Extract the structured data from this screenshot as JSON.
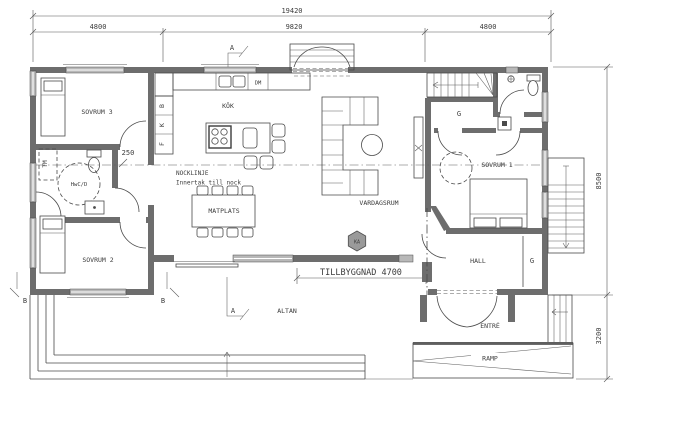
{
  "plan": {
    "dims": {
      "total": "19420",
      "seg_left": "4800",
      "seg_mid": "9820",
      "seg_right": "4800",
      "depth_main": "8500",
      "depth_lower": "3200",
      "corridor": "250",
      "extension": "TILLBYGGNAD 4700"
    },
    "rooms": {
      "sovrum3": "SOVRUM 3",
      "sovrum2": "SOVRUM 2",
      "sovrum1": "SOVRUM 1",
      "bathroom": "HwC/D",
      "kitchen": "KÖK",
      "dining": "MATPLATS",
      "living": "VARDAGSRUM",
      "hall": "HALL",
      "entry": "ENTRÉ",
      "terrace": "ALTAN",
      "ramp": "RAMP"
    },
    "fixtures": {
      "washing_machine": "TM",
      "dishwasher": "DM",
      "cabinet_top": "B",
      "cabinet_mid": "K",
      "cabinet_bottom": "F",
      "wardrobe_upper": "G",
      "wardrobe_hall": "G",
      "badge": "KA"
    },
    "notes": {
      "ridge_line": "NOCKLINJE",
      "ridge_note": "Innertak till nock"
    },
    "sections": {
      "a": "A",
      "b": "B"
    },
    "colors": {
      "wall": "#6d6d6d",
      "window": "#b8b8b8",
      "line": "#4a4a4a",
      "text": "#3c3c3c",
      "background": "#ffffff"
    }
  }
}
